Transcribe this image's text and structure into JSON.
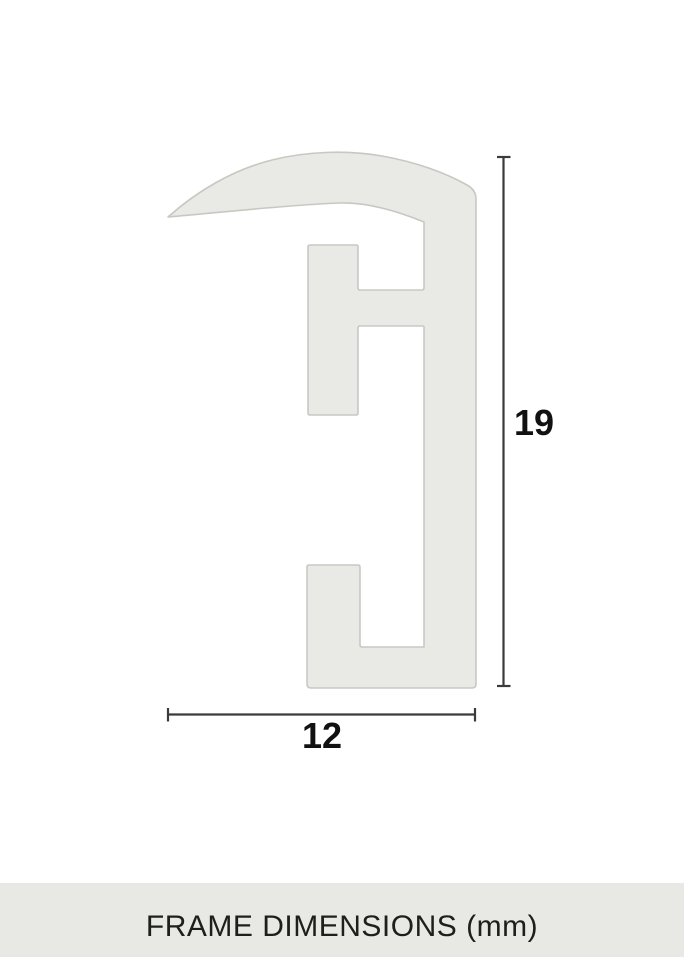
{
  "drawing": {
    "height_value": "19",
    "width_value": "12"
  },
  "footer": {
    "label": "FRAME DIMENSIONS (mm)"
  },
  "colors": {
    "page_background": "#ffffff",
    "profile_fill": "#e9e9e5",
    "profile_stroke": "#c8c8c3",
    "dimension_line": "#3b3b3b",
    "dimension_text": "#111111",
    "footer_background": "#e8e9e4",
    "footer_text": "#1e1e1c"
  }
}
